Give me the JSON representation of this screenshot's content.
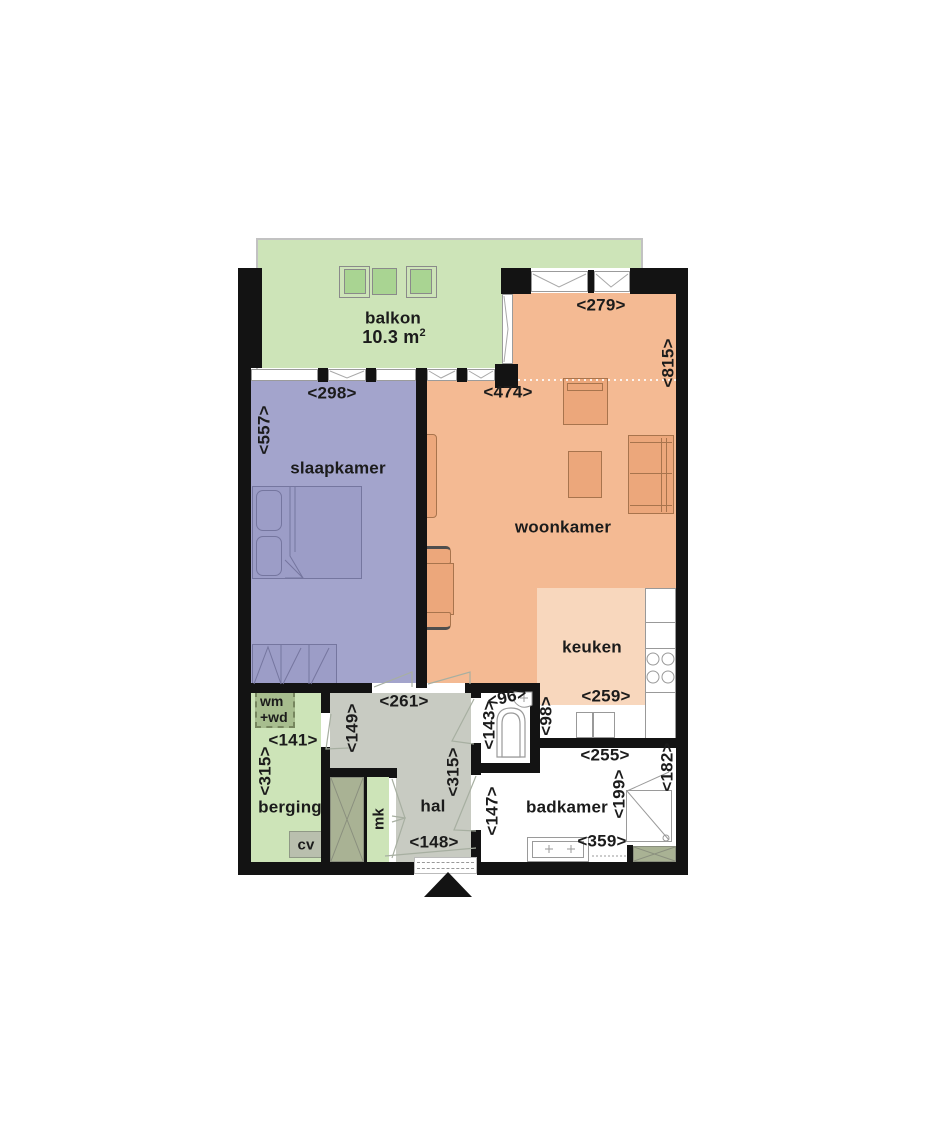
{
  "labels": {
    "balkon": "balkon",
    "balkon_area": "10.3 m",
    "balkon_area_sup": "2",
    "slaapkamer": "slaapkamer",
    "woonkamer": "woonkamer",
    "keuken": "keuken",
    "berging": "berging",
    "hal": "hal",
    "badkamer": "badkamer",
    "mk": "mk",
    "wm_line1": "wm",
    "wm_line2": "+wd",
    "cv": "cv"
  },
  "dims": {
    "slaapkamer_w": "<298>",
    "woonkamer_balkon_w": "<474>",
    "woonkamer_top_w": "<279>",
    "woonkamer_h": "<815>",
    "slaapkamer_h": "<557>",
    "hal_w": "<261>",
    "hal_door": "<149>",
    "hal_h": "<315>",
    "hal_entry_w": "<148>",
    "berging_w": "<141>",
    "berging_h": "<315>",
    "toilet_w": "<96>",
    "toilet_h": "<143>",
    "keuken_w": "<259>",
    "keuken_strip_h": "<98>",
    "badkamer_w": "<255>",
    "badkamer_h_left": "<147>",
    "badkamer_h_inner": "<199>",
    "badkamer_h_right": "<182>",
    "badkamer_w_bottom": "<359>"
  },
  "colors": {
    "wall": "#131313",
    "balkon_green": "#cde4b8",
    "slaapkamer_purple": "#a3a4cc",
    "woonkamer_orange": "#f4ba93",
    "keuken_light": "#f8d7bd",
    "hal_gray": "#c8cbc2",
    "berging_green": "#cde4b8",
    "closet_olive": "#a9b294",
    "wm_box_green": "#a7bd8e",
    "cv_box_gray": "#b9bfae"
  }
}
